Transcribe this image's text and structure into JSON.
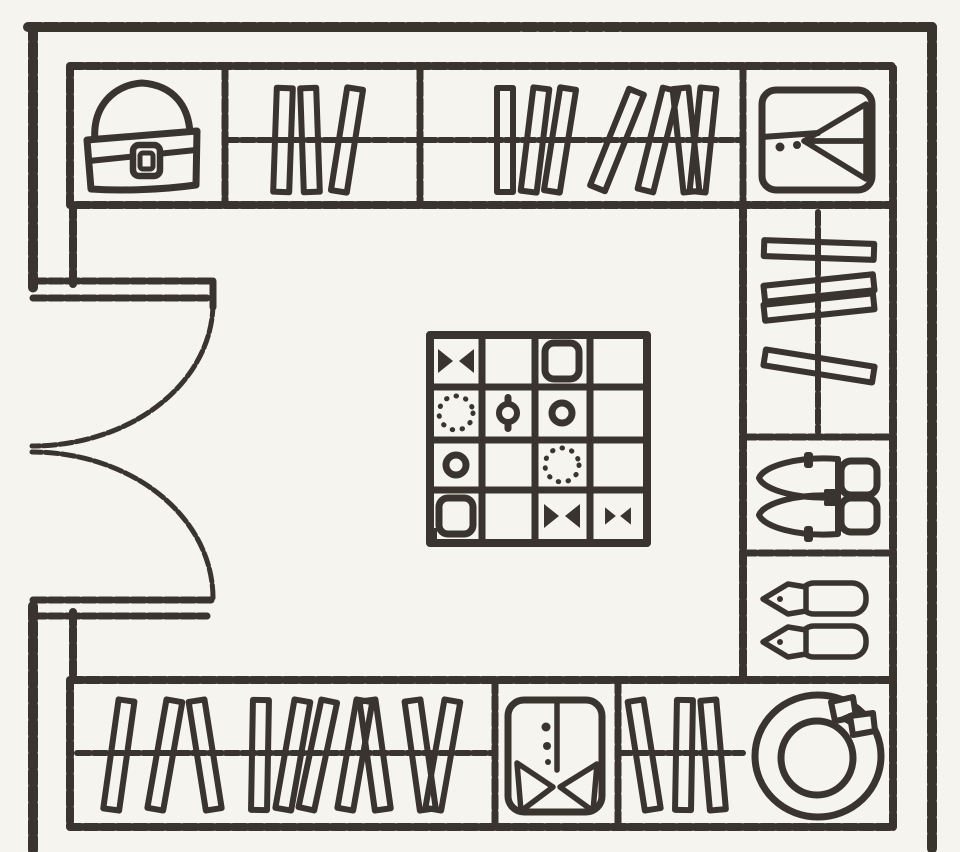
{
  "meta": {
    "diagram_type": "walk-in closet floor plan",
    "colors": {
      "paper": "#f6f4ef",
      "ink": "#39342e"
    }
  },
  "door": {
    "type": "double-swing",
    "label": "entry double doors"
  },
  "island": {
    "label": "island accessory chest (4x4 drawers)",
    "rows": 4,
    "cols": 4,
    "cells": [
      [
        "bowtie",
        "",
        "box",
        ""
      ],
      [
        "beads",
        "ring",
        "donut",
        ""
      ],
      [
        "donut",
        "",
        "beads",
        ""
      ],
      [
        "box",
        "",
        "bowtie",
        "bowtie-sm"
      ]
    ]
  },
  "cabinets": {
    "handbag": {
      "label": "handbag shelf",
      "icon": "handbag-icon"
    },
    "shirt": {
      "label": "folded shirt shelf",
      "icon": "folded-shirt-icon"
    },
    "shoes": {
      "label": "shoe shelf",
      "icon": "shoes-icon"
    },
    "slippers": {
      "label": "slipper shelf",
      "icon": "slippers-icon"
    },
    "hat": {
      "label": "hat box shelf",
      "icon": "hat-icon"
    },
    "suit": {
      "label": "suit cabinet",
      "icon": "suit-icon"
    }
  },
  "racks": {
    "top_left": {
      "label": "hanging rail, 3 garments",
      "items": [
        {
          "x": 283,
          "r": 2
        },
        {
          "x": 310,
          "r": -2
        },
        {
          "x": 347,
          "r": 9
        }
      ]
    },
    "top_right": {
      "label": "hanging rail, 7 garments",
      "items": [
        {
          "x": 505,
          "r": 0
        },
        {
          "x": 535,
          "r": 7
        },
        {
          "x": 560,
          "r": 9
        },
        {
          "x": 617,
          "r": 22
        },
        {
          "x": 658,
          "r": 14
        },
        {
          "x": 686,
          "r": -6
        },
        {
          "x": 703,
          "r": 6
        }
      ]
    },
    "bottom_left": {
      "label": "hanging rail, 10 garments",
      "items": [
        {
          "x": 119,
          "r": 8
        },
        {
          "x": 165,
          "r": 10
        },
        {
          "x": 205,
          "r": -9
        },
        {
          "x": 260,
          "r": 1
        },
        {
          "x": 293,
          "r": 10
        },
        {
          "x": 318,
          "r": 12
        },
        {
          "x": 355,
          "r": 10
        },
        {
          "x": 375,
          "r": -8
        },
        {
          "x": 420,
          "r": -8
        },
        {
          "x": 443,
          "r": 10
        }
      ]
    },
    "bottom_right": {
      "label": "hanging rail, 3 garments",
      "items": [
        {
          "x": 644,
          "r": -9
        },
        {
          "x": 684,
          "r": 1
        },
        {
          "x": 713,
          "r": -5
        }
      ]
    },
    "side": {
      "label": "side hanging rail, 4 garments",
      "orient": "h",
      "items": [
        {
          "y": 250,
          "r": 2
        },
        {
          "y": 288,
          "r": -6
        },
        {
          "y": 307,
          "r": -6
        },
        {
          "y": 366,
          "r": 9
        }
      ]
    }
  }
}
